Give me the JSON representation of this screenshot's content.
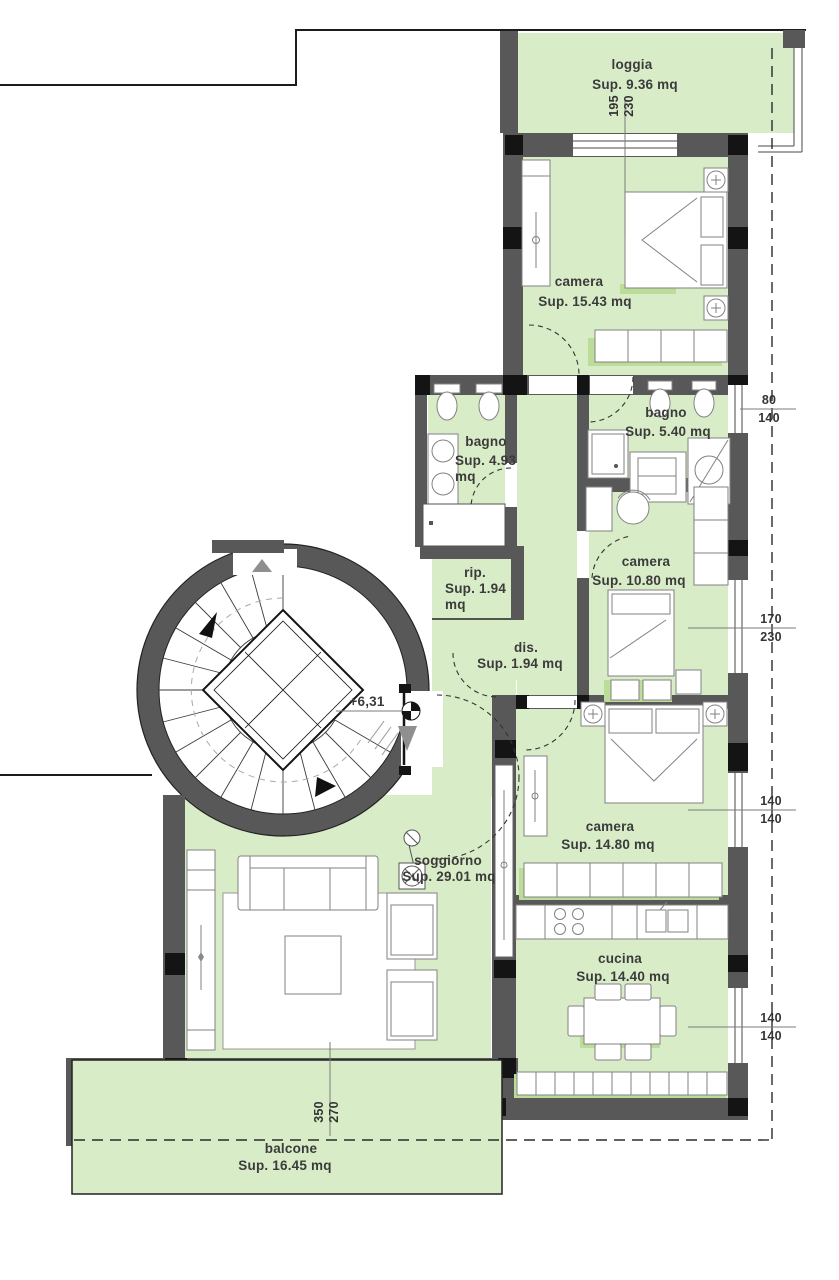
{
  "plan": {
    "rooms": {
      "loggia": {
        "label": "loggia",
        "area": "Sup. 9.36 mq"
      },
      "camera_top": {
        "label": "camera",
        "area": "Sup. 15.43 mq"
      },
      "bagno_small": {
        "label": "bagno",
        "area_line1": "Sup. 4.93",
        "area_line2": "mq"
      },
      "bagno": {
        "label": "bagno",
        "area": "Sup. 5.40 mq"
      },
      "camera_mid": {
        "label": "camera",
        "area": "Sup. 10.80 mq"
      },
      "rip": {
        "label": "rip.",
        "area_line1": "Sup. 1.94",
        "area_line2": "mq"
      },
      "dis": {
        "label": "dis.",
        "area": "Sup. 1.94 mq"
      },
      "camera_low": {
        "label": "camera",
        "area": "Sup. 14.80 mq"
      },
      "soggiorno": {
        "label": "soggiorno",
        "area": "Sup. 29.01 mq"
      },
      "cucina": {
        "label": "cucina",
        "area": "Sup. 14.40 mq"
      },
      "balcone": {
        "label": "balcone",
        "area": "Sup. 16.45 mq"
      }
    },
    "level_marker": "+6,31",
    "dimensions": {
      "loggia_window": {
        "w": "195",
        "h": "230"
      },
      "bagno_window": {
        "w": "80",
        "h": "140"
      },
      "camera_mid_window": {
        "w": "170",
        "h": "230"
      },
      "camera_low_window": {
        "w": "140",
        "h": "140"
      },
      "cucina_window": {
        "w": "140",
        "h": "140"
      },
      "balcone_door": {
        "w": "350",
        "h": "270"
      }
    },
    "colors": {
      "green": "#d9ecc8",
      "accent": "#bcdd9a",
      "wall": "#585858",
      "black": "#141414"
    }
  }
}
